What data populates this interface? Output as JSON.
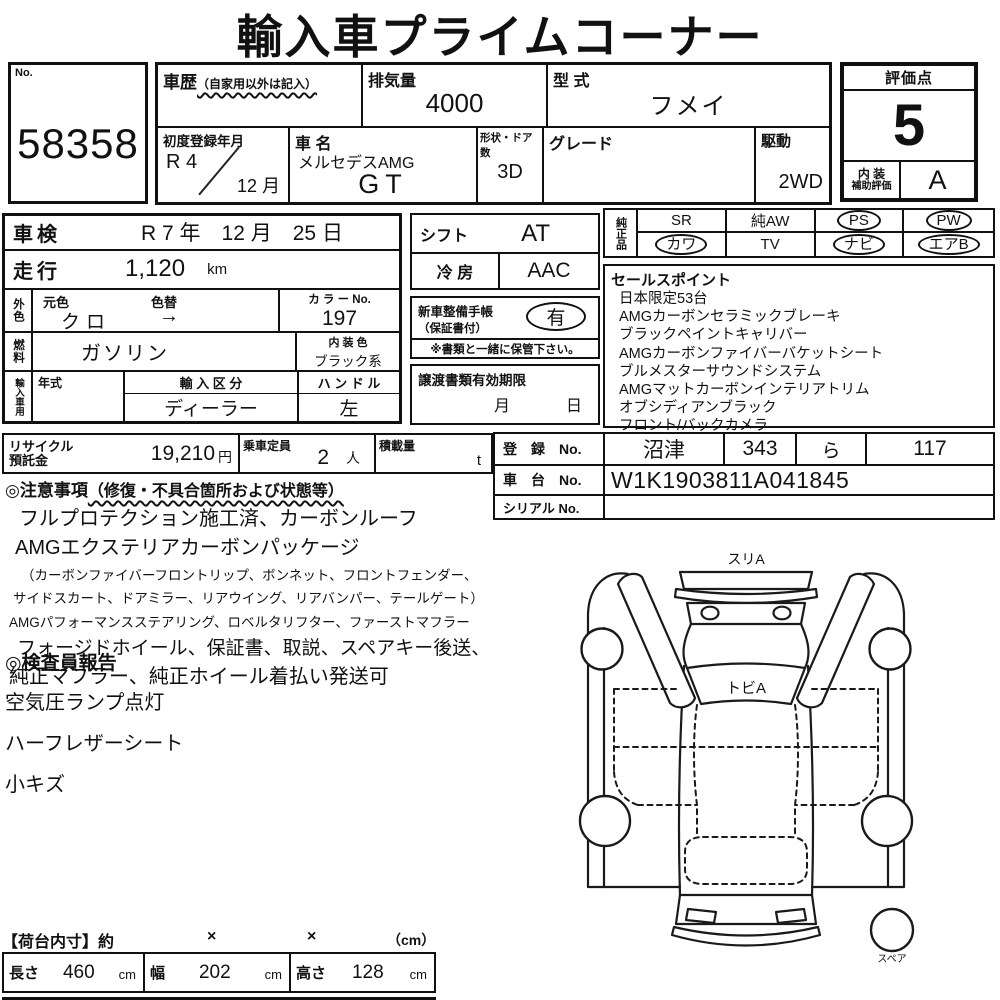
{
  "title": "輸入車プライムコーナー",
  "no_box": {
    "label": "No.",
    "value": "58358"
  },
  "spec": {
    "history_label": "車歴",
    "history_note": "（自家用以外は記入）",
    "displacement_label": "排気量",
    "displacement_value": "4000",
    "model_label": "型 式",
    "model_value": "フメイ",
    "first_reg_label": "初度登録年月",
    "first_reg_year": "R 4",
    "first_reg_month": "12 月",
    "car_name_label": "車 名",
    "car_name_line1": "メルセデスAMG",
    "car_name_line2": "GT",
    "body_doors_label": "形状・ドア数",
    "body_doors_value": "3D",
    "grade_label": "グレード",
    "grade_value": "",
    "drive_label": "駆動",
    "drive_value": "2WD"
  },
  "rating": {
    "label": "評価点",
    "score": "5",
    "interior_line1": "内 装",
    "interior_line2": "補助評価",
    "interior_grade": "A"
  },
  "left": {
    "inspection_label": "車検",
    "inspection_value": "R 7 年　12 月　25 日",
    "mileage_label": "走行",
    "mileage_value": "1,120",
    "mileage_unit": "km",
    "exterior_label": "外色",
    "base_color_label": "元色",
    "color_change_label": "色替",
    "base_color_value": "クロ",
    "color_change_value": "→",
    "color_no_label": "カ ラ ー No.",
    "color_no_value": "197",
    "fuel_label": "燃料",
    "fuel_value": "ガソリン",
    "interior_color_label": "内 装 色",
    "interior_color_value": "ブラック系",
    "import_label": "輸入車用",
    "year_label": "年式",
    "import_type_label": "輸 入 区 分",
    "import_type_value": "ディーラー",
    "steering_label": "ハ ン ド ル",
    "steering_value": "左"
  },
  "mid": {
    "shift_label": "シフト",
    "shift_value": "AT",
    "aircon_label": "冷 房",
    "aircon_value": "AAC",
    "service_book_label1": "新車整備手帳",
    "service_book_label2": "（保証書付）",
    "service_book_value": "有",
    "service_book_note": "※書類と一緒に保管下さい。",
    "transfer_docs_label": "譲渡書類有効期限",
    "transfer_month_label": "月",
    "transfer_day_label": "日"
  },
  "genuine": {
    "label": "純正品",
    "items": [
      {
        "text": "SR",
        "circled": false
      },
      {
        "text": "純AW",
        "circled": false
      },
      {
        "text": "PS",
        "circled": true
      },
      {
        "text": "PW",
        "circled": true
      },
      {
        "text": "カワ",
        "circled": true
      },
      {
        "text": "TV",
        "circled": false
      },
      {
        "text": "ナビ",
        "circled": true
      },
      {
        "text": "エアB",
        "circled": true
      }
    ]
  },
  "sales": {
    "header": "セールスポイント",
    "lines": [
      "日本限定53台",
      "AMGカーボンセラミックブレーキ",
      "ブラックペイントキャリバー",
      "AMGカーボンファイバーバケットシート",
      "ブルメスターサウンドシステム",
      "AMGマットカーボンインテリアトリム",
      "オブシディアンブラック",
      "フロント/バックカメラ"
    ]
  },
  "recycle": {
    "label_line1": "リサイクル",
    "label_line2": "預託金",
    "value": "19,210",
    "unit": "円",
    "capacity_label": "乗車定員",
    "capacity_value": "2",
    "capacity_unit": "人",
    "load_label": "積載量",
    "load_unit": "t"
  },
  "registration": {
    "reg_label": "登　録　No.",
    "reg_area": "沼津",
    "reg_class": "343",
    "reg_kana": "ら",
    "reg_number": "117",
    "chassis_label": "車　台　No.",
    "chassis_value": "W1K1903811A041845",
    "serial_label": "シリアル No.",
    "serial_value": ""
  },
  "notes": {
    "header": "◎注意事項",
    "header_note": "（修復・不具合箇所および状態等）",
    "lines": [
      "フルプロテクション施工済、カーボンルーフ",
      "AMGエクステリアカーボンパッケージ",
      "（カーボンファイバーフロントリップ、ボンネット、フロントフェンダー、",
      "サイドスカート、ドアミラー、リアウイング、リアバンパー、テールゲート）",
      "AMGパフォーマンスステアリング、ロベルタリフター、ファーストマフラー",
      "フォージドホイール、保証書、取説、スペアキー後送、",
      "純正マフラー、純正ホイール着払い発送可"
    ]
  },
  "inspector": {
    "header": "◎検査員報告",
    "lines": [
      "空気圧ランプ点灯",
      "ハーフレザーシート",
      "小キズ"
    ]
  },
  "diagram": {
    "front_damage_label": "スリA",
    "windshield_damage_label": "トビA",
    "spare_label": "スペア"
  },
  "cargo": {
    "header": "【荷台内寸】約",
    "x1": "×",
    "x2": "×",
    "unit_note": "（cm）",
    "length_label": "長さ",
    "length_value": "460",
    "length_unit": "cm",
    "width_label": "幅",
    "width_value": "202",
    "width_unit": "cm",
    "height_label": "高さ",
    "height_value": "128",
    "height_unit": "cm"
  }
}
